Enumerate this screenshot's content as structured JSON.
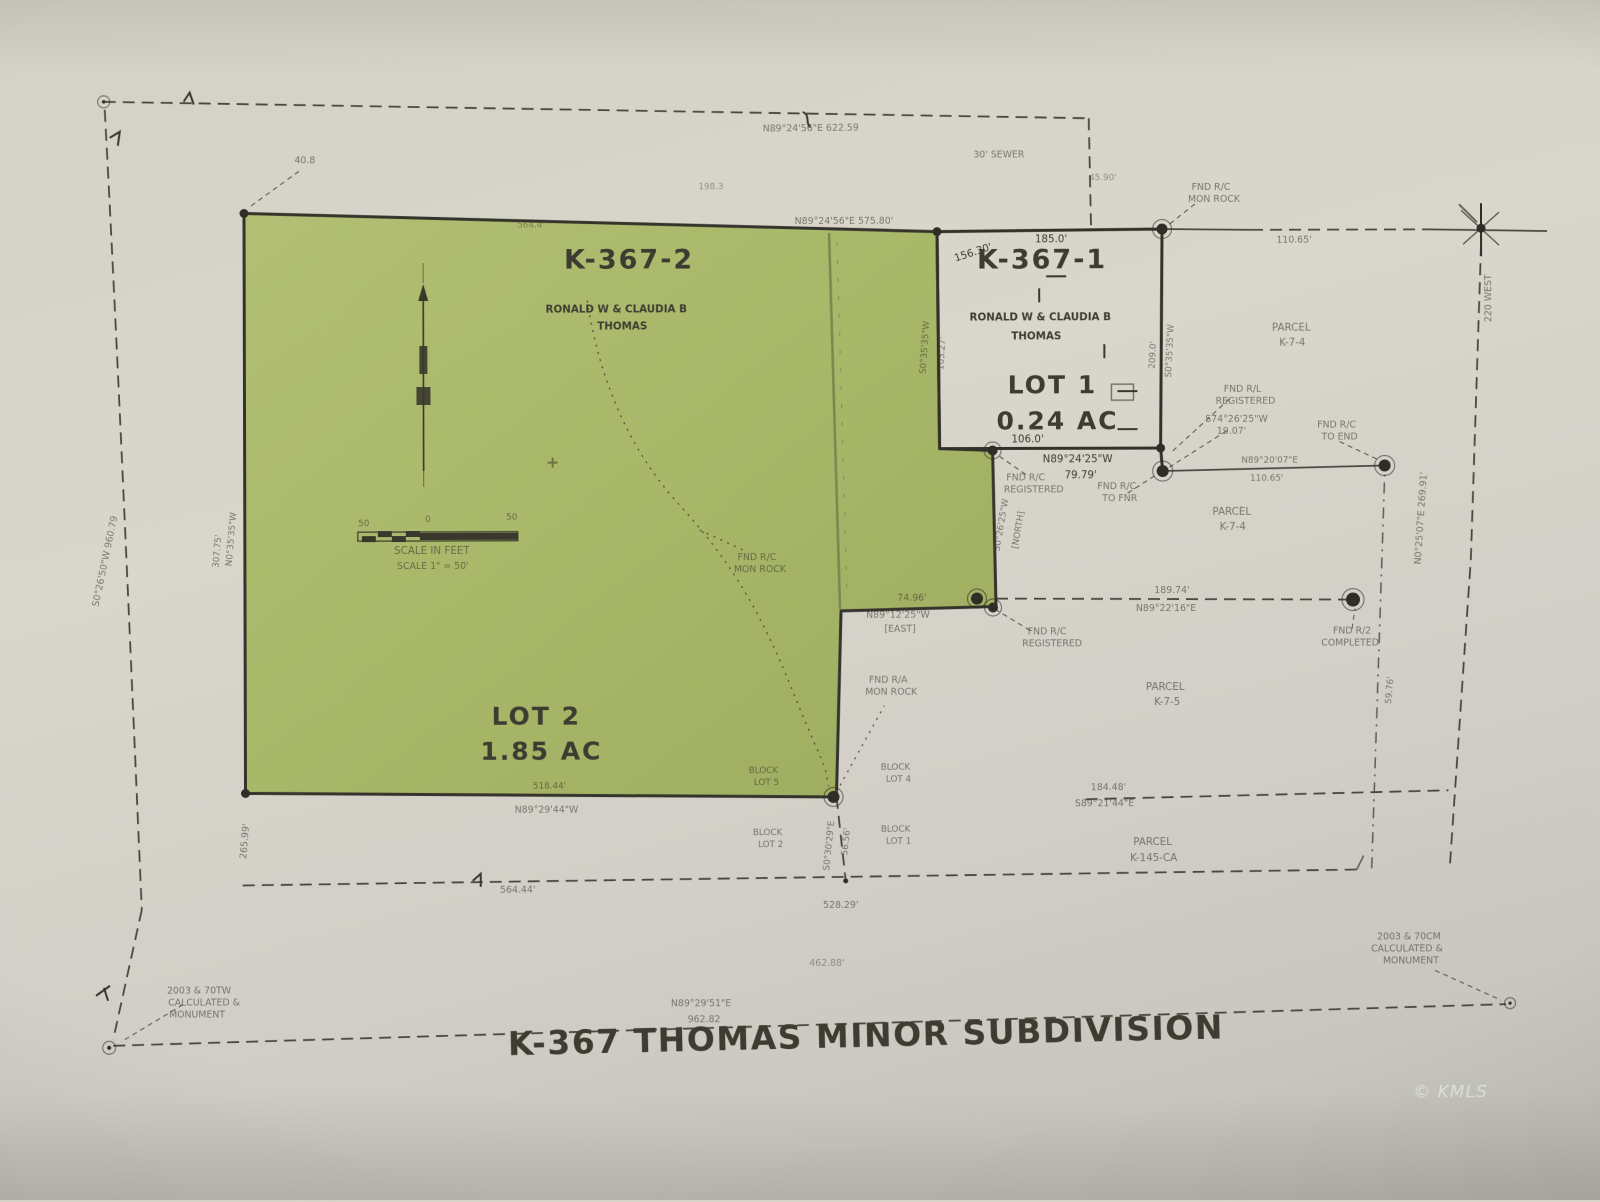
{
  "page": {
    "title": "K-367 THOMAS MINOR SUBDIVISION",
    "watermark": "© KMLS"
  },
  "lots": {
    "lot2": {
      "id": "K-367-2",
      "owner_line1": "RONALD W & CLAUDIA B",
      "owner_line2": "THOMAS",
      "name": "LOT 2",
      "area": "1.85 AC"
    },
    "lot1": {
      "id": "K-367-1",
      "owner_line1": "RONALD W & CLAUDIA B",
      "owner_line2": "THOMAS",
      "name": "LOT 1",
      "area": "0.24 AC"
    }
  },
  "parcels": {
    "ne": [
      "PARCEL",
      "K-7-4"
    ],
    "east": [
      "PARCEL",
      "K-7-4"
    ],
    "se": [
      "PARCEL",
      "K-7-5"
    ],
    "south": [
      "PARCEL",
      "K-145-CA"
    ]
  },
  "scalebar": {
    "left": "50",
    "zero": "0",
    "right": "50",
    "caption": "SCALE IN FEET",
    "note": "SCALE 1\" = 50'"
  },
  "streets": {
    "east": "220 WEST"
  },
  "easements": {
    "sewer": "30' SEWER"
  },
  "found_markers": {
    "ne": [
      "FND R/C",
      "MON ROCK"
    ],
    "rl": [
      "FND R/L",
      "REGISTERED"
    ],
    "tie": [
      "S74°26'25\"W",
      "19.07'"
    ],
    "end": [
      "FND R/C",
      "TO END"
    ],
    "reg": [
      "FND R/C",
      "REGISTERED"
    ],
    "pnr": [
      "FND R/C",
      "TO FNR"
    ],
    "reg2": [
      "FND R/C",
      "REGISTERED"
    ],
    "comp": [
      "FND R/2",
      "COMPLETED"
    ],
    "green": [
      "FND R/C",
      "MON ROCK"
    ],
    "green2": [
      "FND R/A",
      "MON ROCK"
    ]
  },
  "monument_notes": {
    "sw": [
      "2003 & 70TW",
      "CALCULATED &",
      "MONUMENT"
    ],
    "se": [
      "2003 & 70CM",
      "CALCULATED &",
      "MONUMENT"
    ]
  },
  "blocks": {
    "lot5": [
      "BLOCK",
      "LOT 5"
    ],
    "lot4": [
      "BLOCK",
      "LOT 4"
    ],
    "lot2": [
      "BLOCK",
      "LOT 2"
    ],
    "lot1": [
      "BLOCK",
      "LOT 1"
    ]
  },
  "dims": {
    "top_outer": "N89°24'56\"E  622.59",
    "top_green": "N89°24'56\"E  575.80'",
    "green_top": "564.4'",
    "off": "40.8",
    "misc1": "198.3",
    "misc2": "45.90'",
    "lot1_top": "185.0'",
    "lot1_nw": "156.30'",
    "lot1_w_brg": "S0°35'35\"W",
    "lot1_w_len": "103.27'",
    "lot1_e_brg": "S0°35'35\"W",
    "lot1_e_len": "209.0'",
    "lot1_bot": "106.0'",
    "lot1_bot_brg": "N89°24'25\"W",
    "lot1_bot_len": "79.79'",
    "ne_len": "110.65'",
    "e_brg": "N89°20'07\"E",
    "e_len": "110.65'",
    "col_brg": "S0°26'25\"W",
    "col_note": "[NORTH]",
    "notch_len": "74.96'",
    "notch_brg": "N89°12'25\"W",
    "notch_note": "[EAST]",
    "dash_len": "189.74'",
    "dash_brg": "N89°22'16\"E",
    "se_len": "184.48'",
    "se_brg": "S89°21'44\"E",
    "grn_w_brg": "N0°35'35\"W",
    "grn_w_len": "307.75'",
    "out_w": "S0°26'50\"W  960.79",
    "grn_bot_len": "518.44'",
    "grn_bot_brg": "N89°29'44\"W",
    "low_w": "265.99'",
    "col2_brg": "S0°30'29\"E",
    "col2_len": "56.56'",
    "bot1": "564.44'",
    "bot2": "528.29'",
    "bot3": "462.88'",
    "out_bot_brg": "N89°29'51\"E",
    "out_bot_len": "962.82",
    "right_street": "N0°25'07\"E  269.91'",
    "inner_right": "59.76'"
  }
}
